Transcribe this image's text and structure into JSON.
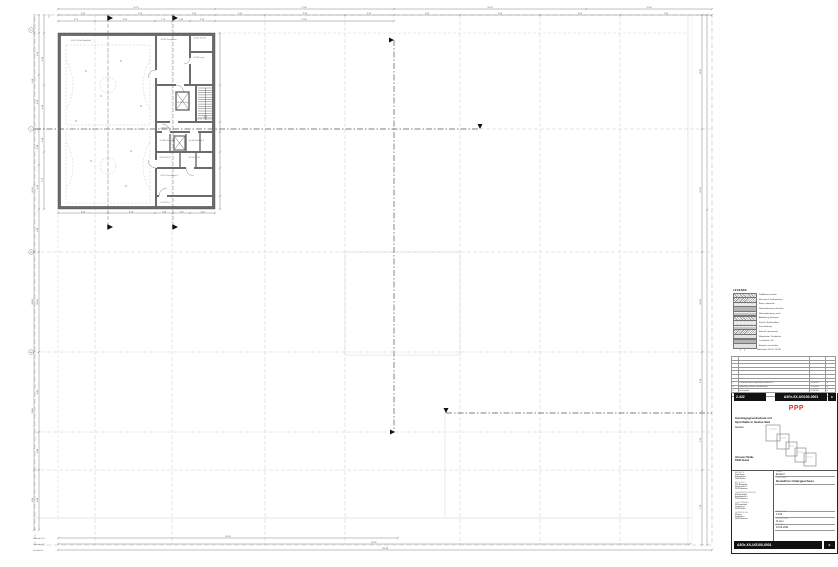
{
  "plan": {
    "rooms": [
      "-1.E.01  2-Feld-Sporthalle",
      "-1.E.02  Geräteraum",
      "-1.E.03  Technik",
      "-1.E.04  Lager",
      "-1.E.06  Aufzug",
      "-1.E.05  Treppenraum",
      "-1.E.07  Flur",
      "-1.E.08  Umkleide 1",
      "-1.E.09  Umkleide 2",
      "-1.E.10  WC-D",
      "-1.E.11  WC-H",
      "-1.E.12  Geräteraum 2",
      "-1.E.13  Flur"
    ],
    "bubbles": {
      "d": "D",
      "c": "C",
      "b": "B",
      "a": "A"
    }
  },
  "dims": {
    "t1": [
      "15.70",
      "17.90",
      "19.20",
      "12.40"
    ],
    "t2": [
      "5.00",
      "6.50",
      "4.20",
      "5.00",
      "8.00",
      "4.90",
      "6.60",
      "8.00",
      "8.00",
      "9.20"
    ],
    "t3": [
      "3.70",
      "6.00",
      "1.70",
      "1.80",
      "2.50",
      "17.90"
    ],
    "t4": [
      "5.00",
      "4.70",
      "1.80",
      "1.70",
      "2.50"
    ],
    "l1": [
      "9.60",
      "12.30",
      "10.00",
      "11.80",
      "6.00"
    ],
    "l2": [
      "4.20",
      "5.40",
      "3.60",
      "4.40",
      "4.30",
      "10.00",
      "8.00",
      "3.80",
      "6.00"
    ],
    "l3": [
      "5.20",
      "4.40",
      "2.30",
      "5.70"
    ],
    "r1": [
      "11.40",
      "12.30",
      "10.00",
      "5.90",
      "5.90",
      "7.50"
    ],
    "b1": {
      "label": "Gebäude UG",
      "value": "45.36"
    },
    "b2": {
      "label": "Gebäude EG",
      "value": "84.52"
    },
    "b3": {
      "label": "Grundstück",
      "value": "112.88"
    }
  },
  "legend": {
    "title": "LEGENDE",
    "items": [
      "Stahlbeton, bewehrt",
      "Mauerwerk, Kalksandstein",
      "Beton, unbewehrt",
      "Wärmedämmung, druckfest",
      "Wärmedämmung, weich",
      "Abdichtung, bituminös",
      "Estrich / Bodenaufbau",
      "Kiesschüttung",
      "Erdreich, gewachsen",
      "Magerbeton / Sauberkeit",
      "Trockenbau, GK",
      "Bestand, unverändert",
      "Höhenkote OK FF / OK RF"
    ]
  },
  "revisions": {
    "rows": [
      {
        "idx": "c",
        "text": "Planstand Entwurf, Anpassung Grundriss UG",
        "date": "13.04.2021",
        "init": "th"
      },
      {
        "idx": "b",
        "text": "Anpassung Schächte und Bemaßung",
        "date": "26.03.2021",
        "init": "th"
      },
      {
        "idx": "a",
        "text": "Erstausgabe",
        "date": "12.03.2021",
        "init": "th"
      }
    ],
    "header": {
      "idx": "Index",
      "text": "Änderung",
      "date": "Datum",
      "init": "Gez."
    }
  },
  "titleblock": {
    "code": "2-432",
    "doc_number": "A3Gr-XX-UG100-0001",
    "revision": "c",
    "logo": "PPP",
    "logo_color": "#e0312d",
    "project_line1": "Ganztagsgrundschule mit",
    "project_line2": "Sporthalle in Seelze-Süd",
    "project_line3": "Neubau",
    "address_line1": "Ahnsener Straße",
    "address_line2": "30926 Seelze",
    "phase_label": "PHASE",
    "phase": "Entwurf",
    "content_label": "PLANINHALT",
    "content": "Grundriss Untergeschoss",
    "scale_label": "MASSSTAB",
    "scale": "1:100",
    "drawn_label": "GEZEICHNET",
    "drawn": "th.sem",
    "date_label": "DATUM",
    "date": "13.04.2021",
    "parties": [
      {
        "h": "BAUHERR",
        "l1": "Stadt Seelze",
        "l2": "Rathausplatz 1",
        "l3": "30926 Seelze"
      },
      {
        "h": "ARCHITEKT",
        "l1": "PPP Architekten",
        "l2": "Musterstraße 12",
        "l3": "30159 Hannover"
      },
      {
        "h": "TRAGWERKSPLANUNG",
        "l1": "IB Statik GmbH",
        "l2": "Bahnhofstraße 8",
        "l3": "30159 Hannover"
      },
      {
        "h": "TGA-PLANUNG",
        "l1": "PB Haustechnik",
        "l2": "Gartenweg 3",
        "l3": "30926 Seelze"
      },
      {
        "h": "VERMESSUNG",
        "l1": "VB Nord",
        "l2": "Feldstraße 5",
        "l3": "30449 Hannover"
      }
    ]
  }
}
